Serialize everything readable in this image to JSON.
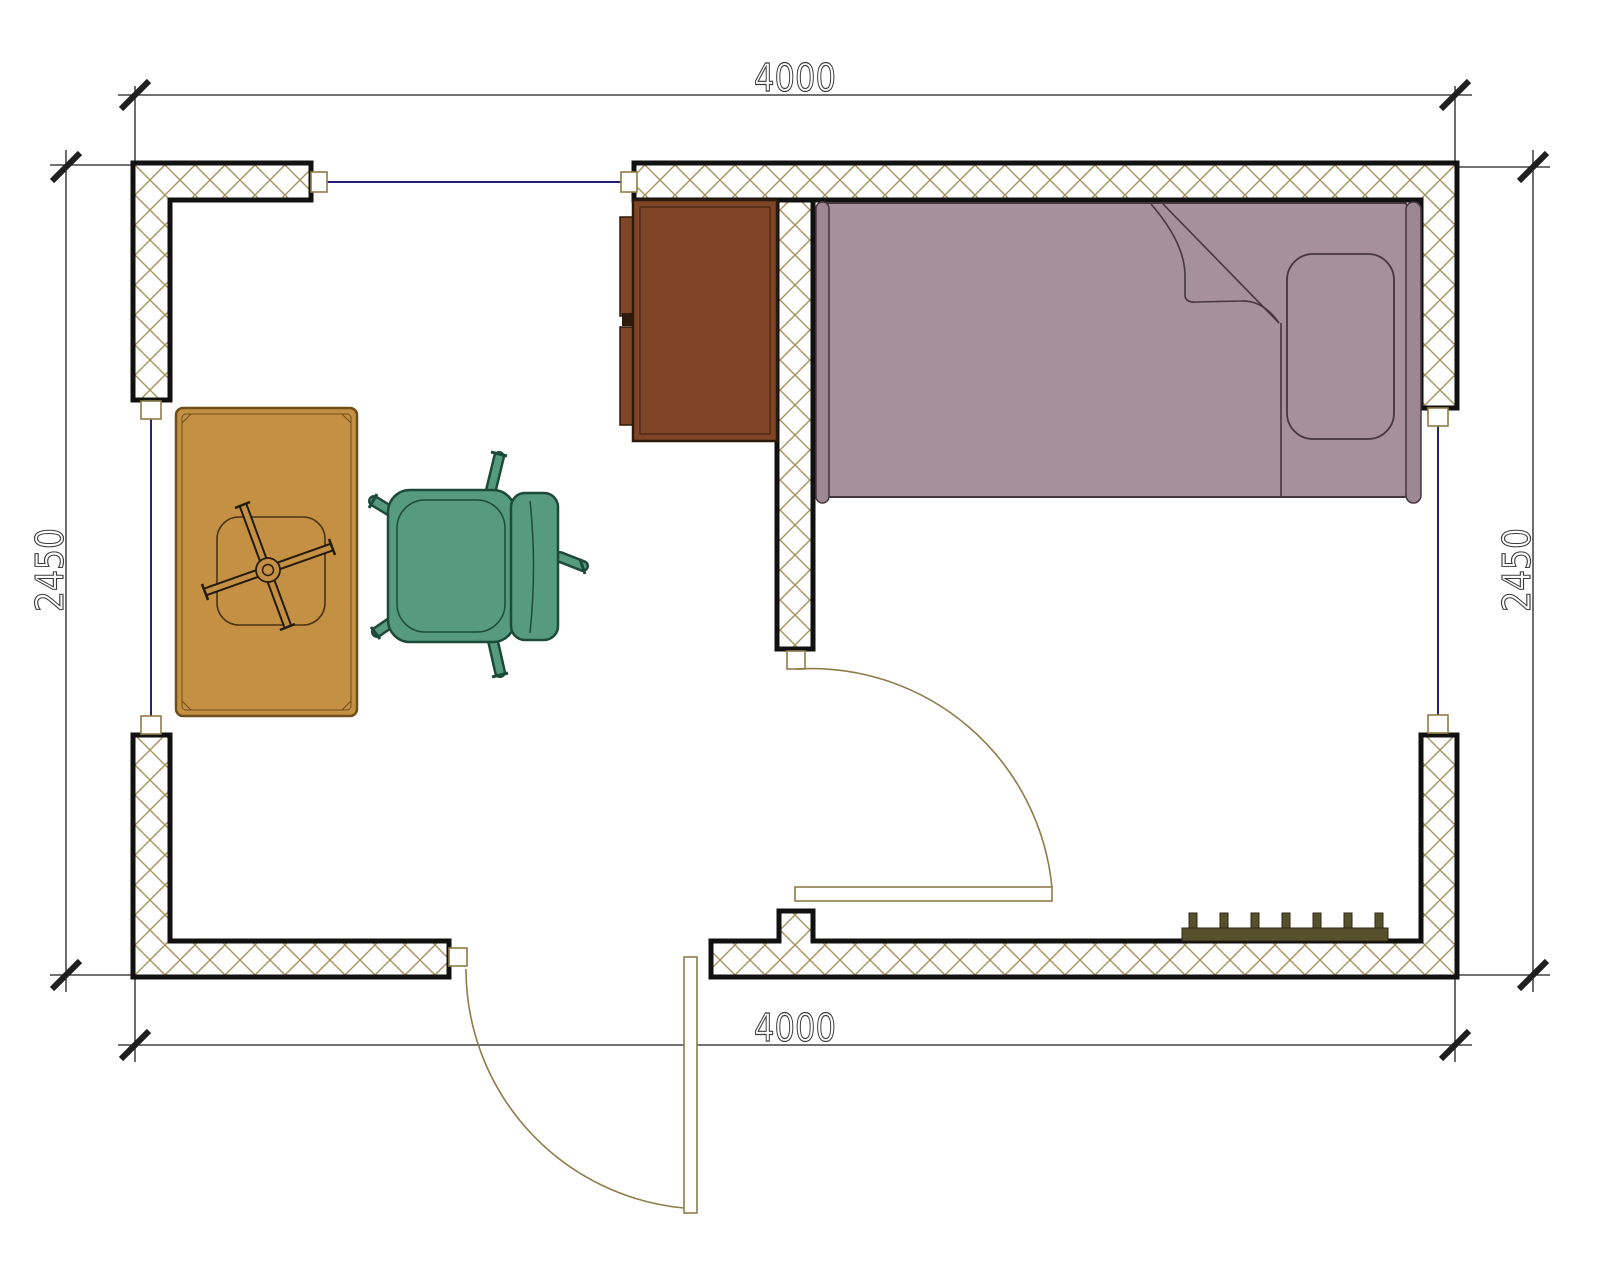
{
  "page": {
    "title": "room-floor-plan",
    "background": "#ffffff"
  },
  "dimensions": {
    "top": "4000",
    "bottom": "4000",
    "left": "2450",
    "right": "2450"
  },
  "colors": {
    "wall_outline": "#111111",
    "wall_hatch": "#a5925f",
    "window_glass": "#22227a",
    "door": "#8f7c4a",
    "dimension_line": "#1f1f1f",
    "dimension_text": "#3c3c3c",
    "bed_fill": "#a5909c",
    "bed_rail": "#9c8793",
    "bed_outline": "#46363f",
    "cabinet_fill": "#7f4526",
    "cabinet_outline": "#2e1a0b",
    "table_fill": "#c49044",
    "table_outline": "#6e4f17",
    "chair_fill": "#569b80",
    "chair_outline": "#1d4a39",
    "radiator_fill": "#57502c"
  },
  "legend": {
    "furniture": [
      "bed",
      "cabinet",
      "table",
      "office-chair",
      "radiator"
    ],
    "openings": [
      "window-top",
      "window-left",
      "window-right",
      "door-interior",
      "door-exterior"
    ]
  }
}
